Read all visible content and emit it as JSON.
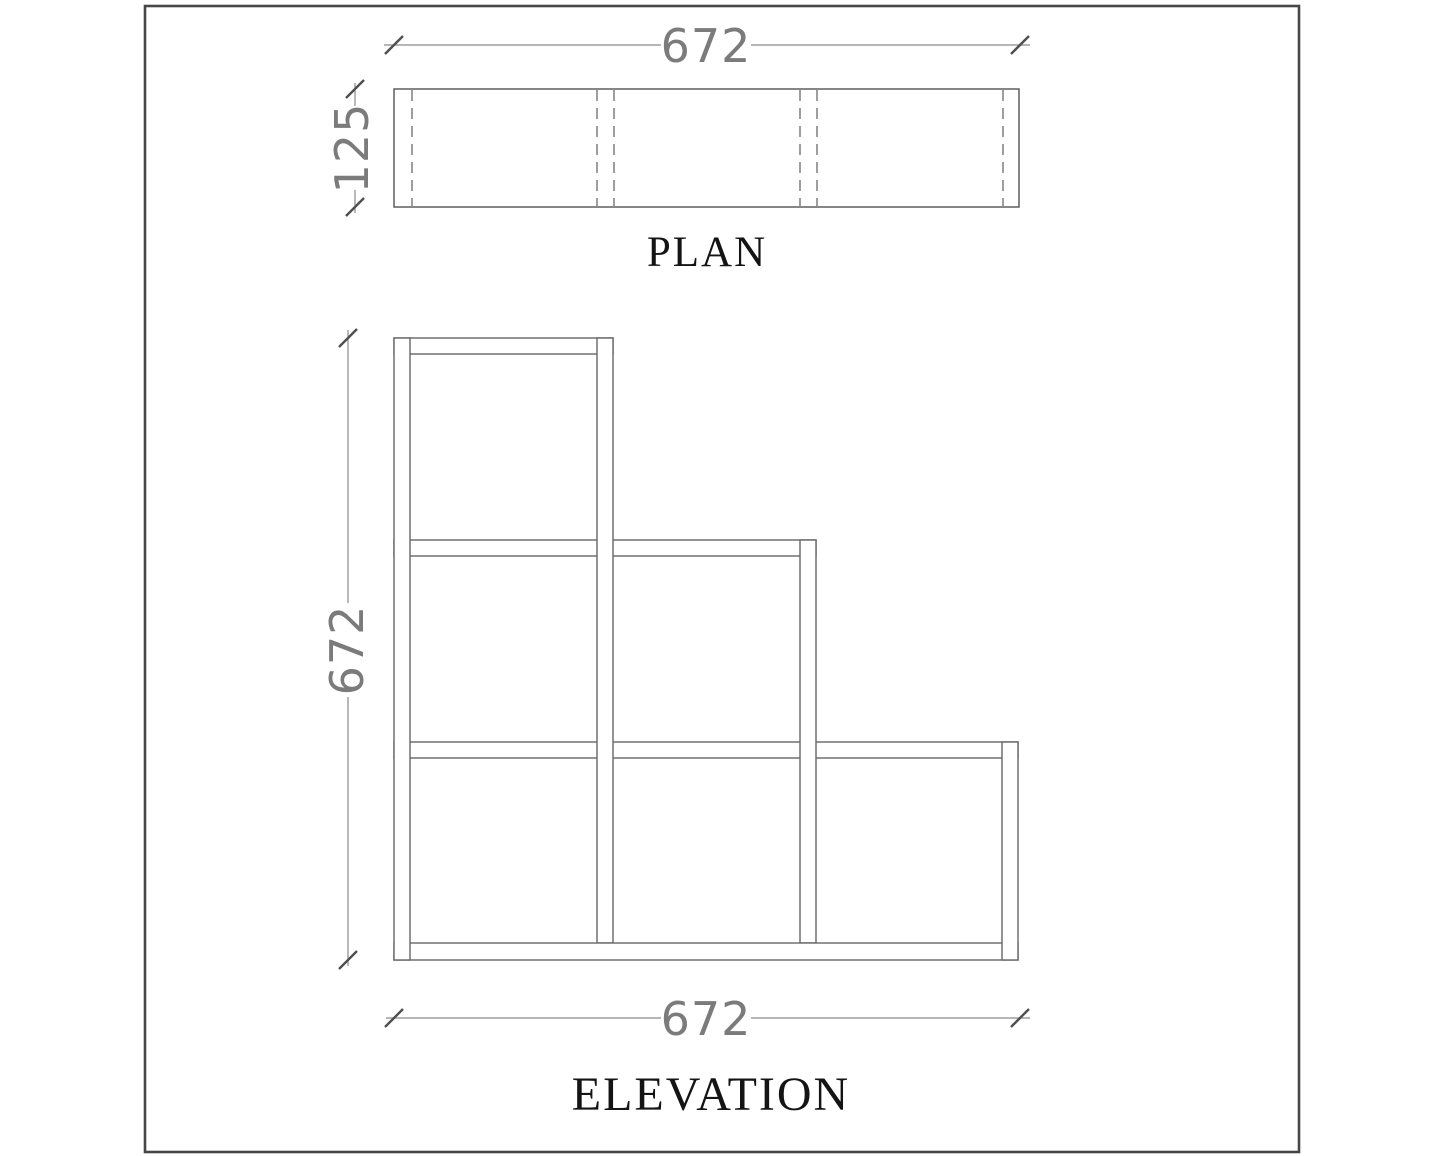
{
  "drawing": {
    "plan": {
      "title": "PLAN",
      "width_label": "672",
      "depth_label": "125"
    },
    "elevation": {
      "title": "ELEVATION",
      "height_label": "672",
      "width_label": "672"
    }
  },
  "colors": {
    "line": "#666666",
    "hidden_line": "#6a6a6a",
    "dimension_line": "#8a8a8a",
    "dimension_text": "#7b7b7b",
    "title_text": "#141414",
    "border_frame": "#474747",
    "background": "#ffffff"
  }
}
